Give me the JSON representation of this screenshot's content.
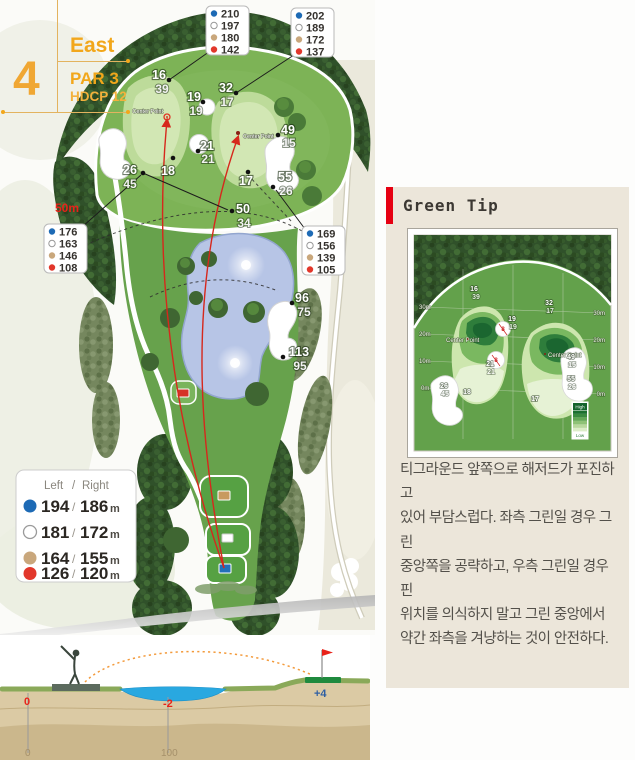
{
  "header": {
    "hole": "4",
    "course": "East",
    "par": "PAR 3",
    "hdcp": "HDCP 12"
  },
  "colors": {
    "accent_gold": "#F2A71B",
    "tip_red": "#E60012",
    "flight_red": "#D6281C",
    "dot_blue": "#1D6AB5",
    "dot_white": "#FFFFFF",
    "dot_tan": "#C9A77C",
    "dot_red": "#E2372B",
    "water": "#B7C5E6",
    "profile_water": "#29A8E0"
  },
  "legend_boxes": {
    "dot_order": [
      "blue",
      "white",
      "tan",
      "red"
    ],
    "top_left": [
      "210",
      "197",
      "180",
      "142"
    ],
    "top_right": [
      "202",
      "189",
      "172",
      "137"
    ],
    "mid_left": [
      "176",
      "163",
      "146",
      "108"
    ],
    "mid_right": [
      "169",
      "156",
      "139",
      "105"
    ]
  },
  "tee_legend": {
    "left": "Left",
    "slash": "/",
    "right": "Right",
    "rows": [
      {
        "l": "194",
        "sep": "/",
        "r": "186",
        "u": "m"
      },
      {
        "l": "181",
        "sep": "/",
        "r": "172",
        "u": "m"
      },
      {
        "l": "164",
        "sep": "/",
        "r": "155",
        "u": "m"
      },
      {
        "l": "126",
        "sep": "/",
        "r": "120",
        "u": "m"
      }
    ]
  },
  "map": {
    "fifty": "50m",
    "center_point": "Center Point",
    "markers": {
      "g16a": "16",
      "g16b": "39",
      "g32a": "32",
      "g32b": "17",
      "g19a": "19",
      "g19b": "19",
      "g21a": "21",
      "g21b": "21",
      "g49a": "49",
      "g49b": "15",
      "g26a": "26",
      "g26b": "45",
      "g18": "18",
      "g17": "17",
      "g55a": "55",
      "g55b": "26",
      "g50a": "50",
      "g50b": "34",
      "g96a": "96",
      "g96b": "75",
      "g113a": "113",
      "g113b": "95"
    }
  },
  "green_tip": {
    "title": "Green Tip",
    "body": [
      "티그라운드 앞쪽으로 해저드가 포진하고",
      "있어 부담스럽다. 좌측 그린일 경우 그린",
      "중앙쪽을 공략하고, 우측 그린일 경우 핀",
      "위치를 의식하지 말고 그린 중앙에서",
      "약간 좌측을 겨냥하는 것이 안전하다."
    ],
    "inset": {
      "grid_left": [
        "30m",
        "20m",
        "10m",
        "0m"
      ],
      "grid_right": [
        "30m",
        "20m",
        "10m",
        "0m"
      ],
      "high": "High",
      "low": "Low",
      "slope1": "8",
      "slope2": "8",
      "center_point": "Center Point"
    }
  },
  "profile": {
    "tee_elev": "0",
    "water_elev": "-2",
    "green_elev": "+4",
    "d_start": "0",
    "d_mid": "100"
  }
}
